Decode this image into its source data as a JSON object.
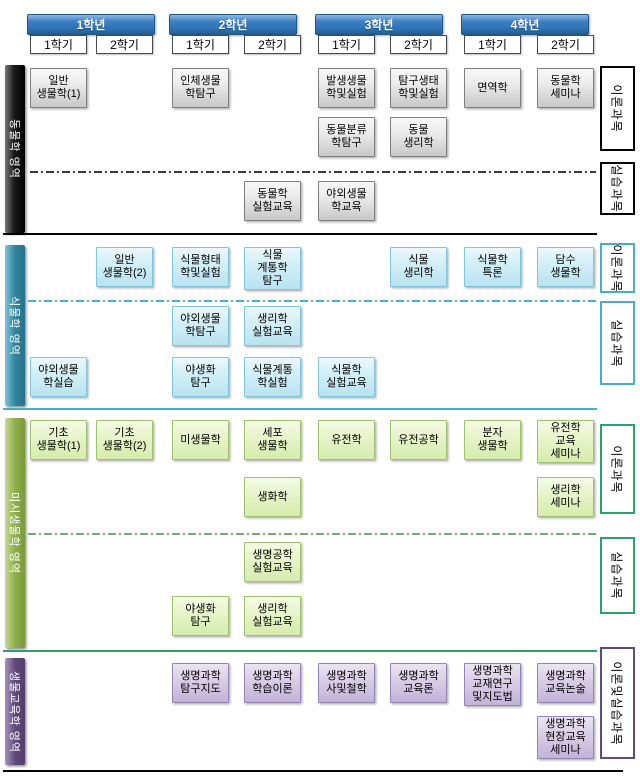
{
  "years": [
    {
      "label": "1학년",
      "semesters": [
        "1학기",
        "2학기"
      ]
    },
    {
      "label": "2학년",
      "semesters": [
        "1학기",
        "2학기"
      ]
    },
    {
      "label": "3학년",
      "semesters": [
        "1학기",
        "2학기"
      ]
    },
    {
      "label": "4학년",
      "semesters": [
        "1학기",
        "2학기"
      ]
    }
  ],
  "sections": [
    {
      "id": "animal",
      "name": "동물학 영역",
      "courses": [
        {
          "label": "일반\n생물학(1)",
          "col": "1-1",
          "row": 0
        },
        {
          "label": "인체생물\n학탐구",
          "col": "2-1",
          "row": 0
        },
        {
          "label": "발생생물\n학및실험",
          "col": "3-1",
          "row": 0
        },
        {
          "label": "탐구생태\n학및실험",
          "col": "3-2",
          "row": 0
        },
        {
          "label": "면역학",
          "col": "4-1",
          "row": 0
        },
        {
          "label": "동물학\n세미나",
          "col": "4-2",
          "row": 0
        },
        {
          "label": "동물분류\n학탐구",
          "col": "3-1",
          "row": 1
        },
        {
          "label": "동물\n생리학",
          "col": "3-2",
          "row": 1
        },
        {
          "label": "동물학\n실험교육",
          "col": "2-2",
          "row": 2
        },
        {
          "label": "야외생물\n학교육",
          "col": "3-1",
          "row": 2
        }
      ]
    },
    {
      "id": "plant",
      "name": "식물학 영역",
      "courses": [
        {
          "label": "일반\n생물학(2)",
          "col": "1-2",
          "row": 0
        },
        {
          "label": "식물형태\n학및실험",
          "col": "2-1",
          "row": 0
        },
        {
          "label": "식물\n계통학\n탐구",
          "col": "2-2",
          "row": 0
        },
        {
          "label": "식물\n생리학",
          "col": "3-2",
          "row": 0
        },
        {
          "label": "식물학\n특론",
          "col": "4-1",
          "row": 0
        },
        {
          "label": "담수\n생물학",
          "col": "4-2",
          "row": 0
        },
        {
          "label": "야외생물\n학탐구",
          "col": "2-1",
          "row": 1
        },
        {
          "label": "생리학\n실험교육",
          "col": "2-2",
          "row": 1
        },
        {
          "label": "야외생물\n학실습",
          "col": "1-1",
          "row": 2
        },
        {
          "label": "야생화\n탐구",
          "col": "2-1",
          "row": 2
        },
        {
          "label": "식물계통\n학실험",
          "col": "2-2",
          "row": 2
        },
        {
          "label": "식물학\n실험교육",
          "col": "3-1",
          "row": 2
        }
      ]
    },
    {
      "id": "micro",
      "name": "미시생물학 영역",
      "courses": [
        {
          "label": "기초\n생물학(1)",
          "col": "1-1",
          "row": 0
        },
        {
          "label": "기초\n생물학(2)",
          "col": "1-2",
          "row": 0
        },
        {
          "label": "미생물학",
          "col": "2-1",
          "row": 0
        },
        {
          "label": "세포\n생물학",
          "col": "2-2",
          "row": 0
        },
        {
          "label": "유전학",
          "col": "3-1",
          "row": 0
        },
        {
          "label": "유전공학",
          "col": "3-2",
          "row": 0
        },
        {
          "label": "분자\n생물학",
          "col": "4-1",
          "row": 0
        },
        {
          "label": "유전학\n교육\n세미나",
          "col": "4-2",
          "row": 0
        },
        {
          "label": "생화학",
          "col": "2-2",
          "row": 1
        },
        {
          "label": "생리학\n세미나",
          "col": "4-2",
          "row": 1
        },
        {
          "label": "생명공학\n실험교육",
          "col": "2-2",
          "row": 2
        },
        {
          "label": "야생화\n탐구",
          "col": "2-1",
          "row": 3
        },
        {
          "label": "생리학\n실험교육",
          "col": "2-2",
          "row": 3
        }
      ]
    },
    {
      "id": "bioedu",
      "name": "생물교육학 영역",
      "courses": [
        {
          "label": "생명과학\n탐구지도",
          "col": "2-1",
          "row": 0
        },
        {
          "label": "생명과학\n학습이론",
          "col": "2-2",
          "row": 0
        },
        {
          "label": "생명과학\n사및철학",
          "col": "3-1",
          "row": 0
        },
        {
          "label": "생명과학\n교육론",
          "col": "3-2",
          "row": 0
        },
        {
          "label": "생명과학\n교재연구\n및지도법",
          "col": "4-1",
          "row": 0
        },
        {
          "label": "생명과학\n교육논술",
          "col": "4-2",
          "row": 0
        },
        {
          "label": "생명과학\n현장교육\n세미나",
          "col": "4-2",
          "row": 1
        }
      ]
    }
  ],
  "side_labels": [
    {
      "text": "이론과목",
      "theme": "black"
    },
    {
      "text": "실습과목",
      "theme": "black"
    },
    {
      "text": "이론과목",
      "theme": "blue"
    },
    {
      "text": "실습과목",
      "theme": "blue"
    },
    {
      "text": "이론과목",
      "theme": "green"
    },
    {
      "text": "실습과목",
      "theme": "green"
    },
    {
      "text": "이론및실습과목",
      "theme": "purple"
    }
  ],
  "colors": {
    "header_blue": "#2E75B6",
    "box_gray_border": "#7F7F7F",
    "box_blue_border": "#7FC5DC",
    "box_green_border": "#9CC36B",
    "box_purple_border": "#9385B8",
    "bar_animal": "#000000",
    "bar_plant": "#31859C",
    "bar_micro": "#8FAF4B",
    "bar_bioedu": "#604A7B",
    "label_black": "#000000",
    "label_blue": "#4BACC6",
    "label_green": "#2EA06A",
    "label_purple": "#604A7B"
  }
}
